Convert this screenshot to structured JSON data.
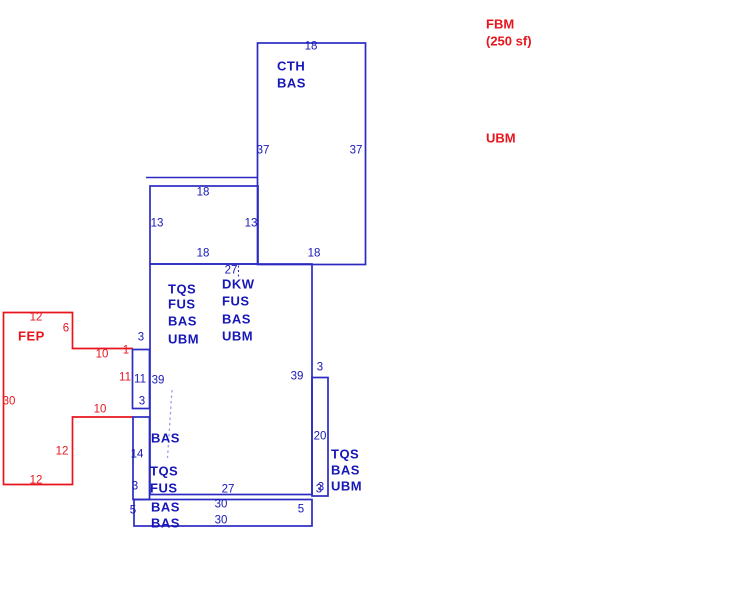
{
  "canvas": {
    "width": 731,
    "height": 602,
    "background": "#ffffff"
  },
  "colors": {
    "blue": "#1717b8",
    "red": "#e8151d",
    "line_blue": "#2b2bc2",
    "dash_blue": "#96a0e8",
    "background": "#ffffff"
  },
  "legend": {
    "fbm": {
      "text": "FBM"
    },
    "fbm_area": {
      "text": "(250 sf)"
    },
    "ubm": {
      "text": "UBM"
    }
  },
  "sketch": {
    "area_labels": [
      {
        "text": "CTH",
        "x": 277,
        "y": 66
      },
      {
        "text": "BAS",
        "x": 277,
        "y": 83
      },
      {
        "text": "TQS",
        "x": 168,
        "y": 289
      },
      {
        "text": "FUS",
        "x": 168,
        "y": 304
      },
      {
        "text": "BAS",
        "x": 168,
        "y": 321
      },
      {
        "text": "UBM",
        "x": 168,
        "y": 339
      },
      {
        "text": "DKW",
        "x": 222,
        "y": 284
      },
      {
        "text": "FUS",
        "x": 222,
        "y": 301
      },
      {
        "text": "BAS",
        "x": 222,
        "y": 319
      },
      {
        "text": "UBM",
        "x": 222,
        "y": 336
      },
      {
        "text": "BAS",
        "x": 151,
        "y": 438
      },
      {
        "text": "TQS",
        "x": 150,
        "y": 471
      },
      {
        "text": "FUS",
        "x": 150,
        "y": 488
      },
      {
        "text": "BAS",
        "x": 151,
        "y": 507
      },
      {
        "text": "BAS",
        "x": 151,
        "y": 523
      },
      {
        "text": "TQS",
        "x": 331,
        "y": 454
      },
      {
        "text": "BAS",
        "x": 331,
        "y": 470
      },
      {
        "text": "UBM",
        "x": 331,
        "y": 486
      },
      {
        "text": "FEP",
        "x": 18,
        "y": 336,
        "color": "red"
      }
    ],
    "dimension_labels": [
      {
        "text": "18",
        "x": 311,
        "y": 47
      },
      {
        "text": "37",
        "x": 263,
        "y": 151
      },
      {
        "text": "37",
        "x": 356,
        "y": 151
      },
      {
        "text": "18",
        "x": 314,
        "y": 254
      },
      {
        "text": "18",
        "x": 203,
        "y": 193
      },
      {
        "text": "13",
        "x": 157,
        "y": 224
      },
      {
        "text": "13",
        "x": 251,
        "y": 224
      },
      {
        "text": "18",
        "x": 203,
        "y": 254
      },
      {
        "text": "27",
        "x": 231,
        "y": 271
      },
      {
        "text": "39",
        "x": 158,
        "y": 381
      },
      {
        "text": "39",
        "x": 297,
        "y": 377
      },
      {
        "text": "27",
        "x": 228,
        "y": 490
      },
      {
        "text": "3",
        "x": 319,
        "y": 490
      },
      {
        "text": "3",
        "x": 141,
        "y": 338
      },
      {
        "text": "11",
        "x": 140,
        "y": 380
      },
      {
        "text": "3",
        "x": 142,
        "y": 402
      },
      {
        "text": "14",
        "x": 137,
        "y": 455
      },
      {
        "text": "3",
        "x": 135,
        "y": 487
      },
      {
        "text": "3",
        "x": 320,
        "y": 368
      },
      {
        "text": "20",
        "x": 320,
        "y": 437
      },
      {
        "text": "3",
        "x": 321,
        "y": 488
      },
      {
        "text": "30",
        "x": 221,
        "y": 505
      },
      {
        "text": "30",
        "x": 221,
        "y": 521
      },
      {
        "text": "5",
        "x": 133,
        "y": 511
      },
      {
        "text": "5",
        "x": 301,
        "y": 510
      },
      {
        "text": "12",
        "x": 36,
        "y": 318,
        "color": "red"
      },
      {
        "text": "6",
        "x": 66,
        "y": 329,
        "color": "red"
      },
      {
        "text": "10",
        "x": 102,
        "y": 355,
        "color": "red"
      },
      {
        "text": "1",
        "x": 126,
        "y": 351,
        "color": "red"
      },
      {
        "text": "11",
        "x": 125,
        "y": 378,
        "color": "red"
      },
      {
        "text": "10",
        "x": 100,
        "y": 410,
        "color": "red"
      },
      {
        "text": "30",
        "x": 9,
        "y": 402,
        "color": "red"
      },
      {
        "text": "12",
        "x": 62,
        "y": 452,
        "color": "red"
      },
      {
        "text": "12",
        "x": 36,
        "y": 481,
        "color": "red"
      }
    ]
  }
}
